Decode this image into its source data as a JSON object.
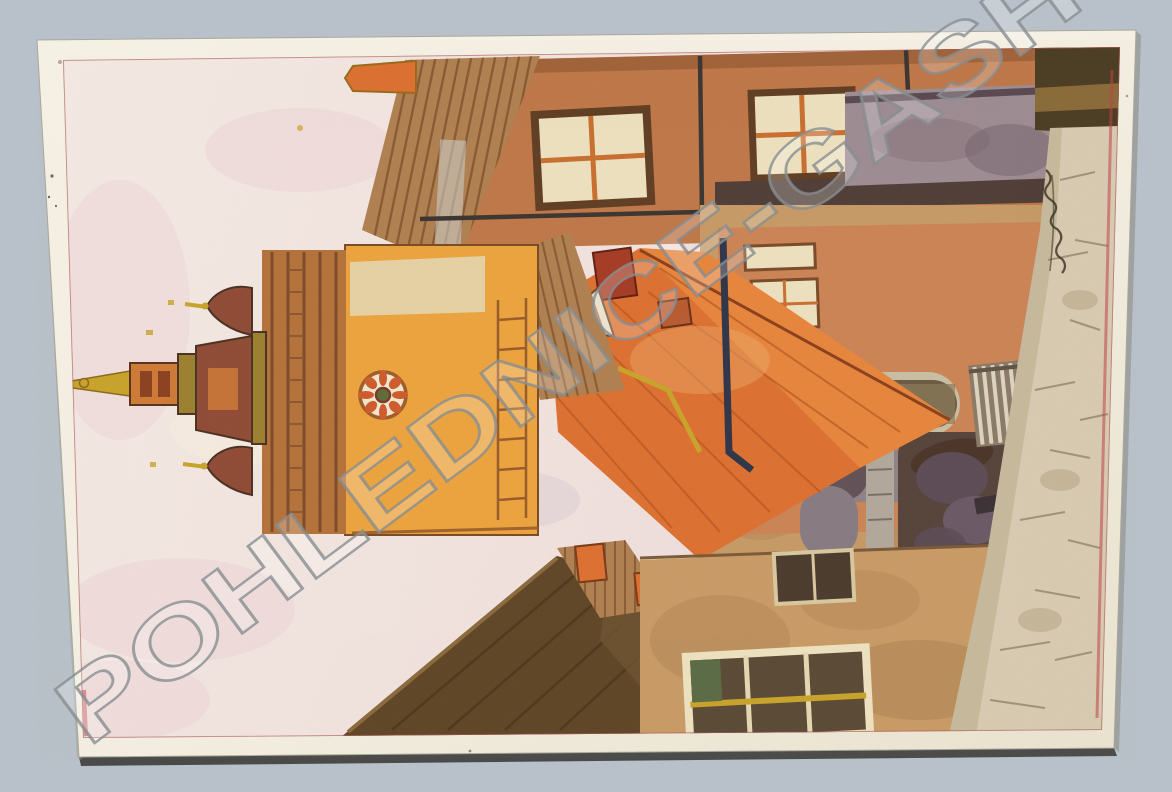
{
  "photo": {
    "kind": "scanned vintage postcard",
    "artwork": "watercolor of an old town street with baroque clock tower, rotated 90 degrees counter-clockwise (sky at left, street at right)"
  },
  "watermark": {
    "text": "POHLEDNICE-GASH"
  },
  "colors": {
    "bg": "#b8c1c9",
    "card": "#f5f0e3",
    "card_edge": "#cfc8b4",
    "shadow": "#2e2d29",
    "sky": "#f4e9e3",
    "sky_pink": "#eed3d7",
    "sky_lavender": "#c9b8cb",
    "terracotta": "#bf7748",
    "terracotta_dark": "#9a5c34",
    "shingle": "#b08050",
    "shingle_line": "#7d4e2a",
    "window_cream": "#eee2c0",
    "mullion": "#c96f2e",
    "outline": "#5f3d22",
    "pipe_dark": "#3a3330",
    "pipe_navy": "#2e3448",
    "graymass": "#9d8c93",
    "graymass_dark": "#53414a",
    "darkolive": "#4a3c22",
    "stone": "#d9ccb3",
    "stone_line": "#8a7a60",
    "street": "#c79a66",
    "street_stain": "#a87c4c",
    "tower": "#eda43d",
    "tower_cream": "#e6d6ae",
    "cornice": "#b5723a",
    "cornice_line": "#7c4a26",
    "spire_maroon": "#8f4a35",
    "spire_orange": "#cf7a36",
    "spire_gold": "#c9a42a",
    "spire_olive": "#9c8030",
    "clock_face": "#f2e8d0",
    "clock_accent": "#cf5a2c",
    "roof_a": "#e8853c",
    "roof_b": "#dd7030",
    "roof_line": "#b5541f",
    "roof_ridge": "#8a3f1a",
    "dormer_red": "#a53a24",
    "darkroof": "#5f4526",
    "darkroof_hi": "#8a6a3c",
    "tanwall": "#c99b66",
    "arch_gray": "#8f8289",
    "arcade": "#cc8455",
    "arch_dark": "#55423a",
    "pillar": "#b3a89c",
    "fig_purple": "#5c4a55",
    "fig_dark": "#4a3428",
    "fig_red": "#c65b4a",
    "lit_yellow": "#e9c467",
    "green_shutter": "#5a6b44",
    "red_edge": "#c04048",
    "wm_stroke": "#878d90",
    "wm_fill": "rgba(255,255,255,0.22)"
  }
}
